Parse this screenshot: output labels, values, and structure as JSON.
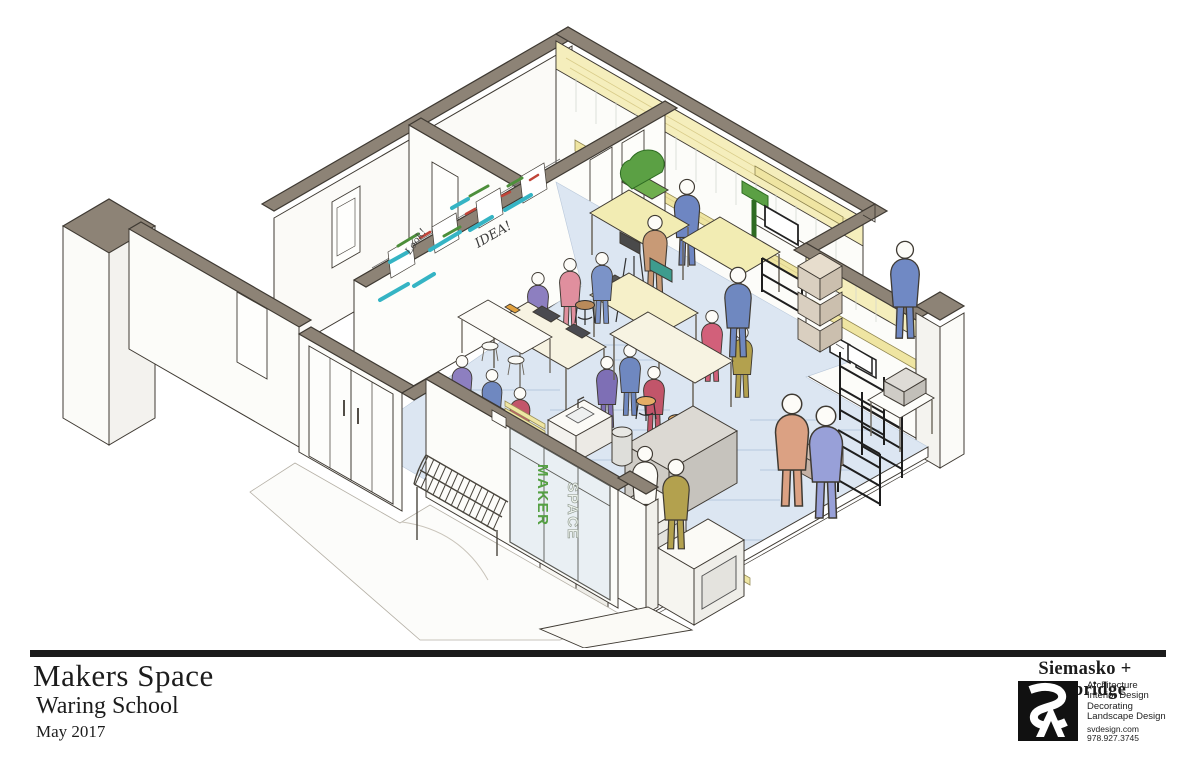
{
  "title_block": {
    "project_title": "Makers Space",
    "client": "Waring School",
    "date": "May 2017"
  },
  "firm": {
    "name": "Siemasko + Verbridge",
    "services": [
      "Architecture",
      "Interior Design",
      "Decorating",
      "Landscape Design"
    ],
    "website": "svdesign.com",
    "phone": "978.927.3745"
  },
  "drawing_labels": {
    "whiteboard_word": "IDEA!",
    "whiteboard_note": "Look!",
    "sign_vertical": [
      "MAKER",
      "SPACE"
    ]
  },
  "palette": {
    "wall_top": "#8d8376",
    "line": "#3f3a33",
    "floor_wash": "#dce6f2",
    "wood_light": "#f5eebc",
    "wood_beam": "#efe5a2",
    "machine_green": "#5ba044",
    "sign_green": "#55a043",
    "scribble_teal": "#35b4c4",
    "scribble_green": "#4d8f3b",
    "scribble_red": "#c04438",
    "stool_seat": "#e5ad66"
  }
}
